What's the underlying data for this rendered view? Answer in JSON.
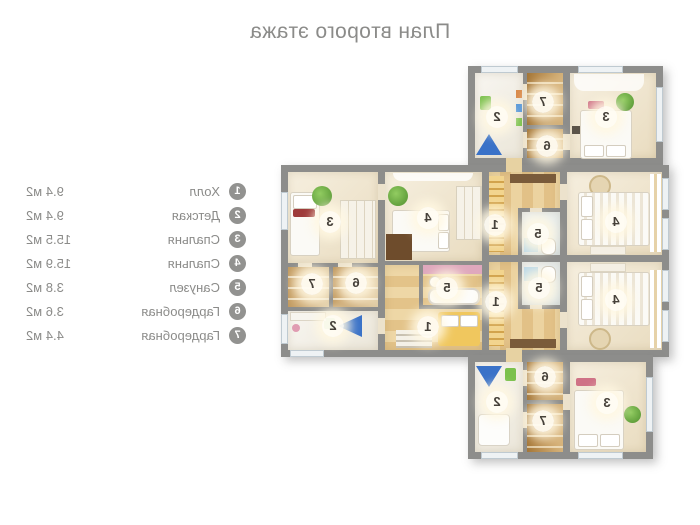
{
  "title": "План второго этажа",
  "legend": {
    "items": [
      {
        "num": "1",
        "name": "Холл",
        "area": "9.4 м2"
      },
      {
        "num": "2",
        "name": "Детская",
        "area": "9.4 м2"
      },
      {
        "num": "3",
        "name": "Спальня",
        "area": "15.5 м2"
      },
      {
        "num": "4",
        "name": "Спальня",
        "area": "15.9 м2"
      },
      {
        "num": "5",
        "name": "Санузел",
        "area": "3.8 м2"
      },
      {
        "num": "6",
        "name": "Гардеробная",
        "area": "3.6 м2"
      },
      {
        "num": "7",
        "name": "Гардеробная",
        "area": "4.4 м2"
      }
    ]
  },
  "plan": {
    "room_labels": {
      "t2": "2",
      "t7": "7",
      "t6": "6",
      "t3": "3",
      "l3": "3",
      "l7": "7",
      "l6": "6",
      "l2": "2",
      "l4": "4",
      "l5": "5",
      "l1": "1",
      "rt1": "1",
      "rt5": "5",
      "rt4": "4",
      "rb1": "1",
      "rb5": "5",
      "rb4": "4",
      "b2": "2",
      "b6": "6",
      "b7": "7",
      "b3": "3"
    }
  },
  "colors": {
    "wall_gray": "#8d8d8b",
    "text_gray": "#8b8b89",
    "tent_blue": "#3a72c8",
    "plant_green": "#6fb64b",
    "hall_wood": "#e6c378",
    "bath_pink": "#dfa8bd"
  }
}
